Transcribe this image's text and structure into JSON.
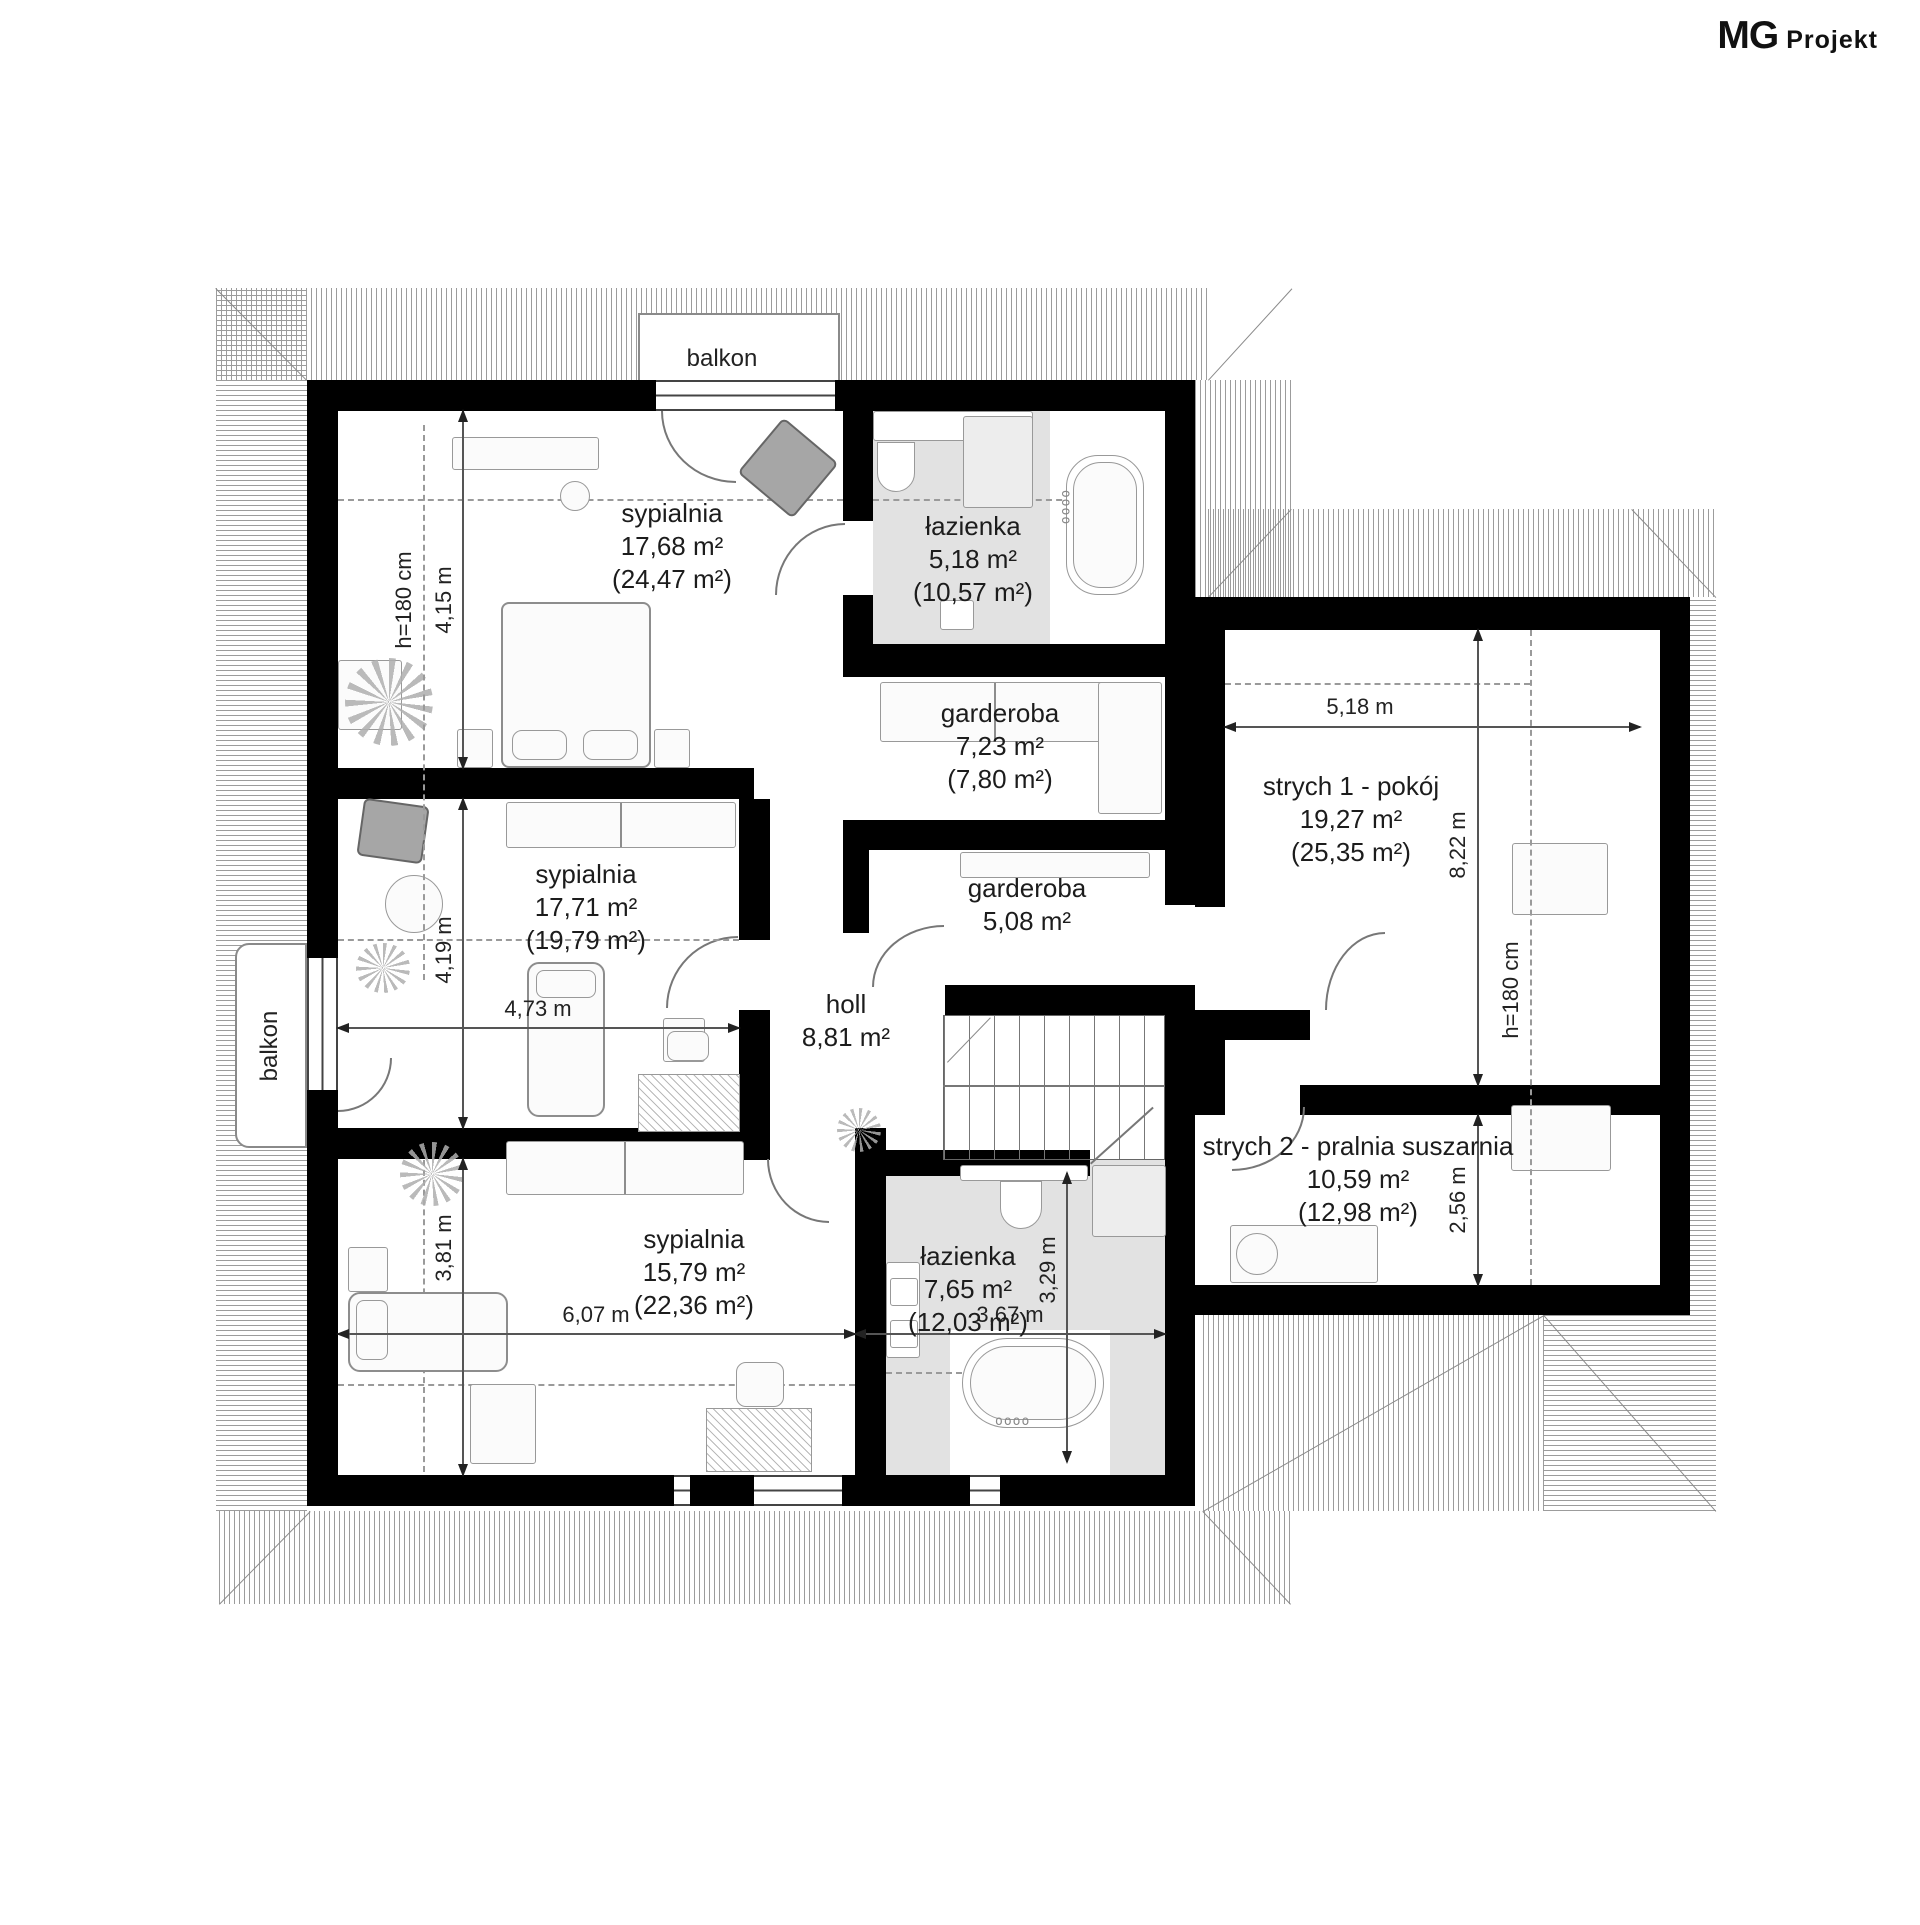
{
  "logo": {
    "mg": "MG",
    "projekt": "Projekt"
  },
  "balconies": {
    "top": "balkon",
    "left": "balkon"
  },
  "rooms": [
    {
      "name": "sypialnia",
      "area": "17,68 m²",
      "total": "(24,47 m²)"
    },
    {
      "name": "łazienka",
      "area": "5,18 m²",
      "total": "(10,57 m²)"
    },
    {
      "name": "garderoba",
      "area": "7,23 m²",
      "total": "(7,80 m²)"
    },
    {
      "name": "strych 1 - pokój",
      "area": "19,27 m²",
      "total": "(25,35 m²)"
    },
    {
      "name": "sypialnia",
      "area": "17,71 m²",
      "total": "(19,79 m²)"
    },
    {
      "name": "garderoba",
      "area": "5,08 m²",
      "total": ""
    },
    {
      "name": "holl",
      "area": "8,81 m²",
      "total": ""
    },
    {
      "name": "sypialnia",
      "area": "15,79 m²",
      "total": "(22,36 m²)"
    },
    {
      "name": "łazienka",
      "area": "7,65 m²",
      "total": "(12,03 m²)"
    },
    {
      "name": "strych 2 - pralnia suszarnia",
      "area": "10,59 m²",
      "total": "(12,98 m²)"
    }
  ],
  "dims": {
    "d415": "4,15 m",
    "h180l": "h=180 cm",
    "d419": "4,19 m",
    "d473": "4,73 m",
    "d381": "3,81 m",
    "d607": "6,07 m",
    "d367": "3,67 m",
    "d329": "3,29 m",
    "d518": "5,18 m",
    "d822": "8,22 m",
    "h180r": "h=180 cm",
    "d256": "2,56 m"
  },
  "colors": {
    "wall": "#000000",
    "bath_floor": "#e2e2e2",
    "furniture_outline": "#8d8d8d",
    "dark_furniture": "#a6a6a6",
    "roof_hatch": "#9c9c9c"
  }
}
